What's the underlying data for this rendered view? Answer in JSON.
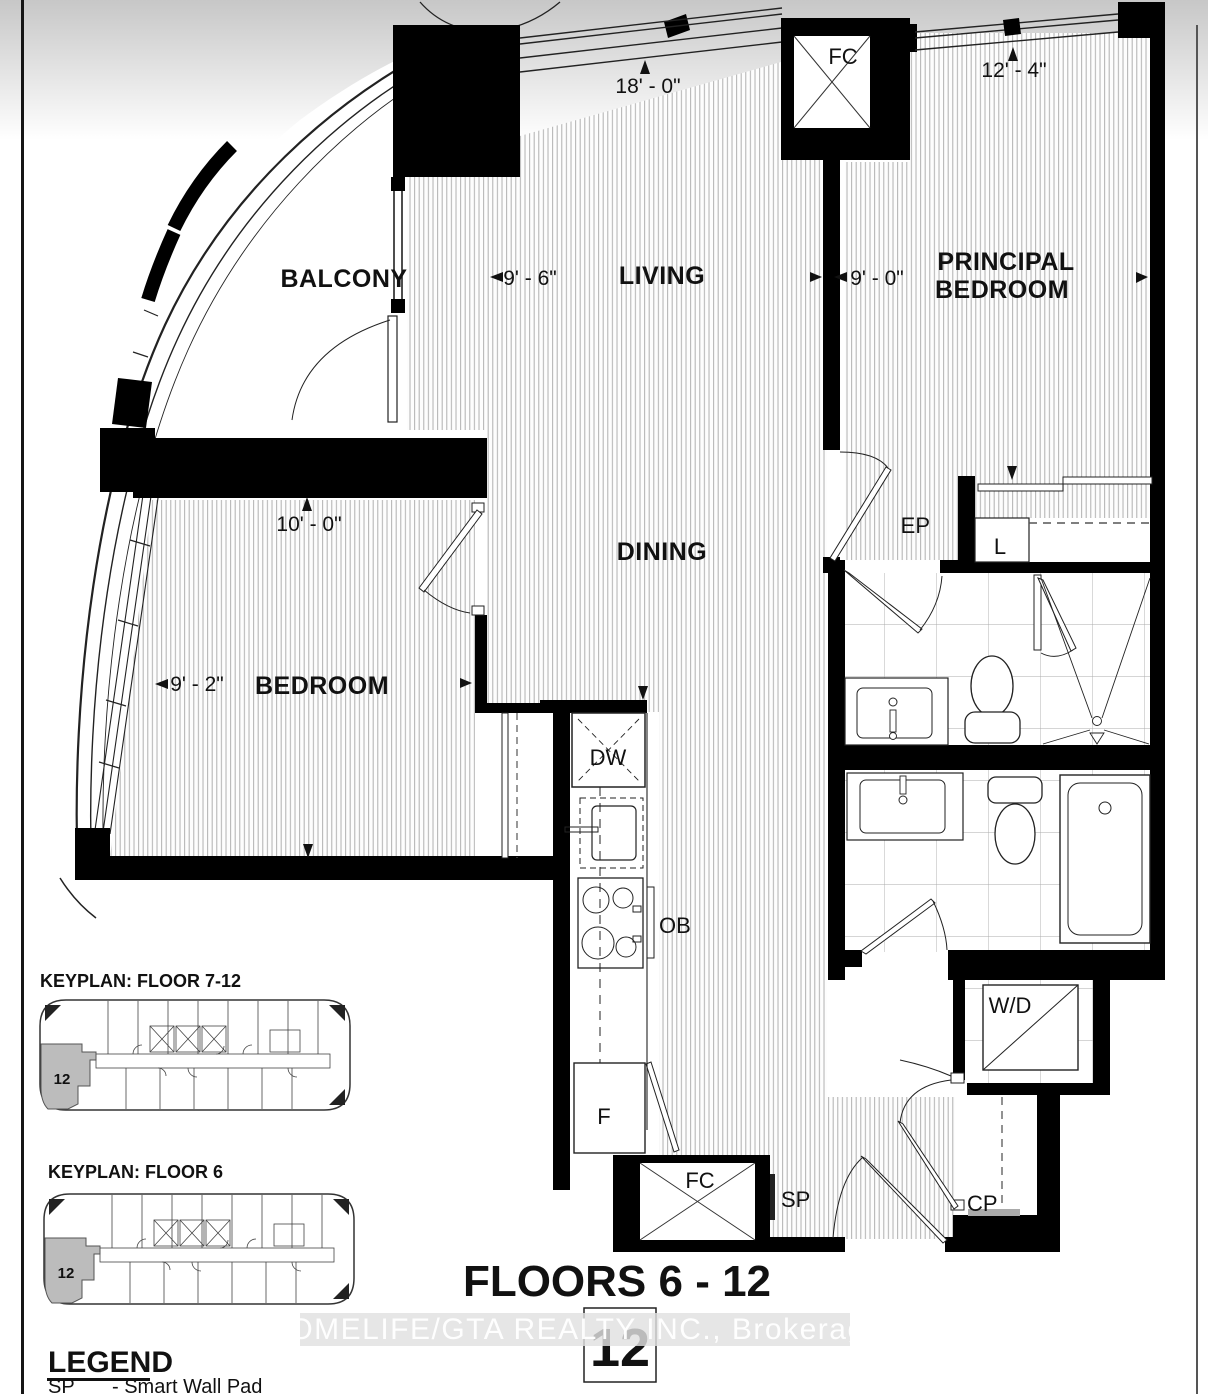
{
  "plan": {
    "rooms": {
      "balcony": "BALCONY",
      "living": "LIVING",
      "dining": "DINING",
      "bedroom": "BEDROOM",
      "principal_line1": "PRINCIPAL",
      "principal_line2": "BEDROOM"
    },
    "dimensions": {
      "living_width": "9' - 6\"",
      "living_length": "18' - 0\"",
      "principal_width": "9' - 0\"",
      "principal_length": "12' - 4\"",
      "bedroom_width": "9' - 2\"",
      "bedroom_length": "10' - 0\""
    },
    "labels": {
      "fc_top": "FC",
      "fc_bottom": "FC",
      "dishwasher": "DW",
      "oven_below": "OB",
      "fridge": "F",
      "ep": "EP",
      "linen": "L",
      "washer_dryer": "W/D",
      "smart_pad": "SP",
      "closet_pantry": "CP"
    }
  },
  "keyplans": [
    {
      "title": "KEYPLAN: FLOOR 7-12",
      "unit": "12"
    },
    {
      "title": "KEYPLAN: FLOOR 6",
      "unit": "12"
    }
  ],
  "footer": {
    "floors": "FLOORS 6 - 12",
    "unit_number": "12"
  },
  "legend": {
    "title": "LEGEND",
    "items": [
      {
        "code": "SP",
        "description": "- Smart Wall Pad"
      }
    ]
  },
  "watermark": "HOMELIFE/GTA REALTY INC., Brokerage",
  "colors": {
    "wall": "#000000",
    "hatch_line": "#b0b0b0",
    "tile_line": "#ababab",
    "highlight_unit": "#bcbcbc",
    "watermark_band": "#e0e0e0",
    "watermark_text": "#ffffff"
  }
}
